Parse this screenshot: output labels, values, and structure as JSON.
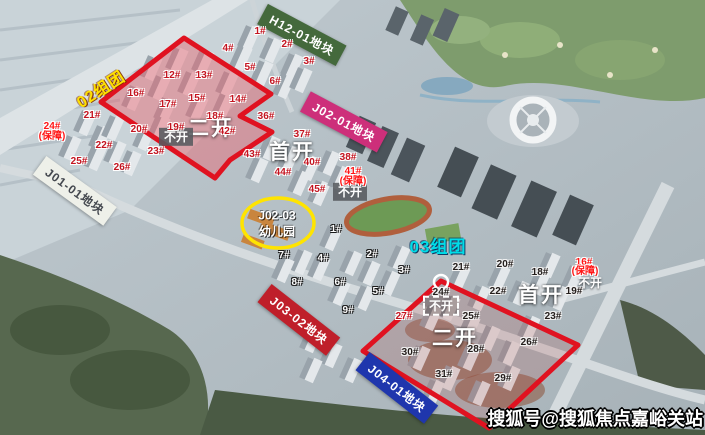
{
  "watermark": {
    "text": "搜狐号@搜狐焦点嘉峪关站"
  },
  "zone_labels": [
    {
      "text": "02组团",
      "color": "#ffe100"
    },
    {
      "text": "03组团",
      "color": "#00dde8"
    }
  ],
  "plot_banners": [
    {
      "label": "H12-01地块",
      "bg": "#44693c",
      "fg": "#ffffff"
    },
    {
      "label": "J02-01地块",
      "bg": "#cd2f7a",
      "fg": "#ffffff"
    },
    {
      "label": "J01-01地块",
      "bg": "#eef0e9",
      "fg": "#43474e"
    },
    {
      "label": "J03-02地块",
      "bg": "#bf1f2a",
      "fg": "#ffffff"
    },
    {
      "label": "J04-01地块",
      "bg": "#1f36ad",
      "fg": "#ffffff"
    }
  ],
  "phase_labels": [
    {
      "text": "二开"
    },
    {
      "text": "首开"
    },
    {
      "text": "首开"
    },
    {
      "text": "二开"
    }
  ],
  "closed_labels": [
    {
      "text": "不开"
    },
    {
      "text": "不开"
    },
    {
      "text": "不开"
    },
    {
      "text": "不开"
    }
  ],
  "kindergarten": {
    "line1": "J02-03",
    "line2": "幼儿园"
  },
  "highlight_colors": {
    "red_outline": "#e01220",
    "yellow_circle": "#ffe400"
  },
  "building_labels": [
    {
      "t": "1#",
      "x": 260,
      "y": 32,
      "k": "r"
    },
    {
      "t": "2#",
      "x": 287,
      "y": 45,
      "k": "r"
    },
    {
      "t": "3#",
      "x": 309,
      "y": 62,
      "k": "r"
    },
    {
      "t": "4#",
      "x": 228,
      "y": 49,
      "k": "r"
    },
    {
      "t": "5#",
      "x": 250,
      "y": 68,
      "k": "r"
    },
    {
      "t": "6#",
      "x": 275,
      "y": 82,
      "k": "r"
    },
    {
      "t": "12#",
      "x": 172,
      "y": 76,
      "k": "r"
    },
    {
      "t": "13#",
      "x": 204,
      "y": 76,
      "k": "r"
    },
    {
      "t": "14#",
      "x": 238,
      "y": 100,
      "k": "r"
    },
    {
      "t": "15#",
      "x": 197,
      "y": 99,
      "k": "r"
    },
    {
      "t": "16#",
      "x": 136,
      "y": 94,
      "k": "r"
    },
    {
      "t": "17#",
      "x": 168,
      "y": 105,
      "k": "r"
    },
    {
      "t": "18#",
      "x": 215,
      "y": 117,
      "k": "r"
    },
    {
      "t": "19#",
      "x": 176,
      "y": 128,
      "k": "r"
    },
    {
      "t": "20#",
      "x": 139,
      "y": 130,
      "k": "r"
    },
    {
      "t": "21#",
      "x": 92,
      "y": 116,
      "k": "r"
    },
    {
      "t": "22#",
      "x": 104,
      "y": 146,
      "k": "r"
    },
    {
      "t": "23#",
      "x": 156,
      "y": 152,
      "k": "r"
    },
    {
      "t": "25#",
      "x": 79,
      "y": 162,
      "k": "r"
    },
    {
      "t": "26#",
      "x": 122,
      "y": 168,
      "k": "r"
    },
    {
      "t": "24#",
      "x": 52,
      "y": 127,
      "k": "b"
    },
    {
      "t": "(保障)",
      "x": 52,
      "y": 137,
      "k": "b"
    },
    {
      "t": "36#",
      "x": 266,
      "y": 117,
      "k": "r"
    },
    {
      "t": "37#",
      "x": 302,
      "y": 135,
      "k": "r"
    },
    {
      "t": "38#",
      "x": 348,
      "y": 158,
      "k": "r"
    },
    {
      "t": "40#",
      "x": 312,
      "y": 163,
      "k": "r"
    },
    {
      "t": "41#",
      "x": 353,
      "y": 172,
      "k": "b"
    },
    {
      "t": "(保障)",
      "x": 353,
      "y": 182,
      "k": "b"
    },
    {
      "t": "42#",
      "x": 227,
      "y": 132,
      "k": "r"
    },
    {
      "t": "43#",
      "x": 252,
      "y": 155,
      "k": "r"
    },
    {
      "t": "44#",
      "x": 283,
      "y": 173,
      "k": "r"
    },
    {
      "t": "45#",
      "x": 317,
      "y": 190,
      "k": "r"
    },
    {
      "t": "27#",
      "x": 404,
      "y": 317,
      "k": "r"
    },
    {
      "t": "16#",
      "x": 584,
      "y": 263,
      "k": "b"
    },
    {
      "t": "(保障)",
      "x": 585,
      "y": 272,
      "k": "b"
    },
    {
      "t": "18#",
      "x": 540,
      "y": 273,
      "k": "d"
    },
    {
      "t": "19#",
      "x": 574,
      "y": 292,
      "k": "d"
    },
    {
      "t": "20#",
      "x": 505,
      "y": 265,
      "k": "d"
    },
    {
      "t": "21#",
      "x": 461,
      "y": 268,
      "k": "d"
    },
    {
      "t": "22#",
      "x": 498,
      "y": 292,
      "k": "d"
    },
    {
      "t": "23#",
      "x": 553,
      "y": 317,
      "k": "d"
    },
    {
      "t": "24#",
      "x": 441,
      "y": 293,
      "k": "d"
    },
    {
      "t": "25#",
      "x": 471,
      "y": 317,
      "k": "d"
    },
    {
      "t": "26#",
      "x": 529,
      "y": 343,
      "k": "d"
    },
    {
      "t": "28#",
      "x": 476,
      "y": 350,
      "k": "d"
    },
    {
      "t": "29#",
      "x": 503,
      "y": 379,
      "k": "d"
    },
    {
      "t": "30#",
      "x": 410,
      "y": 353,
      "k": "d"
    },
    {
      "t": "31#",
      "x": 444,
      "y": 375,
      "k": "d"
    },
    {
      "t": "1#",
      "x": 336,
      "y": 230,
      "k": "w"
    },
    {
      "t": "2#",
      "x": 372,
      "y": 255,
      "k": "w"
    },
    {
      "t": "3#",
      "x": 404,
      "y": 271,
      "k": "w"
    },
    {
      "t": "4#",
      "x": 323,
      "y": 259,
      "k": "w"
    },
    {
      "t": "5#",
      "x": 378,
      "y": 292,
      "k": "w"
    },
    {
      "t": "6#",
      "x": 340,
      "y": 283,
      "k": "w"
    },
    {
      "t": "7#",
      "x": 284,
      "y": 256,
      "k": "w"
    },
    {
      "t": "8#",
      "x": 297,
      "y": 283,
      "k": "w"
    },
    {
      "t": "9#",
      "x": 348,
      "y": 311,
      "k": "w"
    }
  ]
}
